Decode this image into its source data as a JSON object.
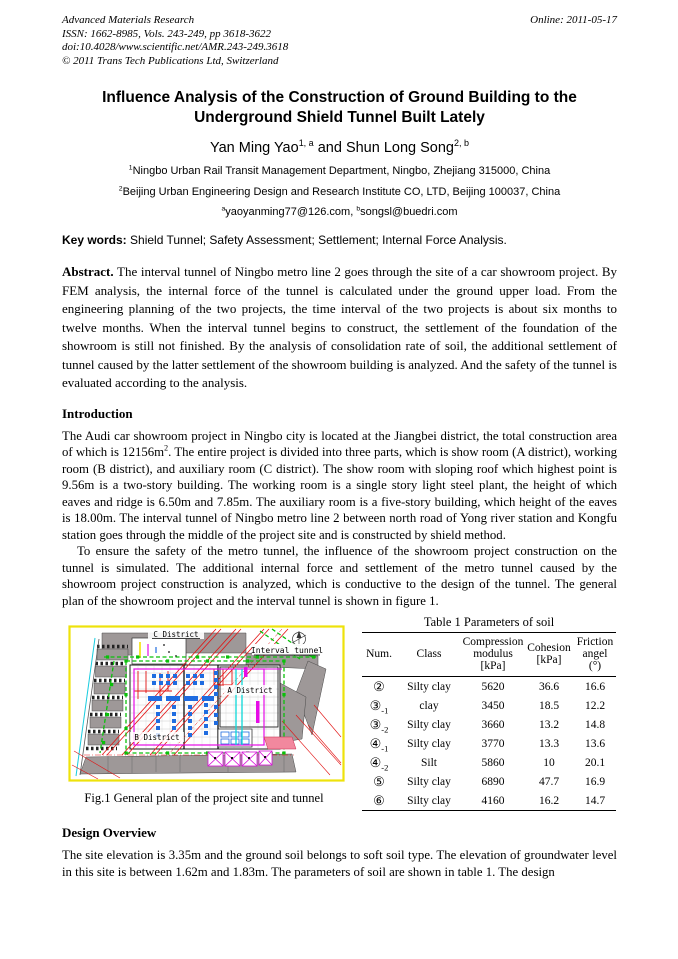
{
  "header": {
    "journal": "Advanced Materials Research",
    "issn": "ISSN: 1662-8985, Vols. 243-249, pp 3618-3622",
    "doi": "doi:10.4028/www.scientific.net/AMR.243-249.3618",
    "copyright": "© 2011 Trans Tech Publications Ltd, Switzerland",
    "online": "Online: 2011-05-17"
  },
  "title": "Influence Analysis of the Construction of Ground Building to the Underground Shield Tunnel Built Lately",
  "authors": {
    "author1": "Yan Ming Yao",
    "author1_sup": "1, a",
    "connector": " and ",
    "author2": "Shun Long Song",
    "author2_sup": "2, b"
  },
  "affiliations": [
    {
      "sup": "1",
      "text": "Ningbo Urban Rail Transit Management Department, Ningbo, Zhejiang 315000, China"
    },
    {
      "sup": "2",
      "text": "Beijing Urban Engineering Design and Research Institute CO, LTD, Beijing 100037, China"
    }
  ],
  "emails": {
    "sup_a": "a",
    "email_a": "yaoyanming77@126.com",
    "separator": ", ",
    "sup_b": "b",
    "email_b": "songsl@buedri.com"
  },
  "keywords": {
    "label": "Key words:",
    "text": " Shield Tunnel; Safety Assessment; Settlement; Internal Force Analysis."
  },
  "abstract": {
    "label": "Abstract.",
    "text": " The interval tunnel of Ningbo metro line 2 goes through the site of a car showroom project. By FEM analysis, the internal force of the tunnel is calculated under the ground upper load. From the engineering planning of the two projects, the time interval of the two projects is about six months to twelve months. When the interval tunnel begins to construct, the settlement of the foundation of the showroom is still not finished. By the analysis of consolidation rate of soil, the additional settlement of tunnel caused by the latter settlement of the showroom building is analyzed. And the safety of the tunnel is evaluated according to the analysis."
  },
  "introduction": {
    "heading": "Introduction",
    "para1_a": "The Audi car showroom project in Ningbo city is located at the Jiangbei district, the total construction area of which is 12156m",
    "para1_sup": "2",
    "para1_b": ". The entire project is divided into three parts, which is show room (A district), working room (B district), and auxiliary room (C district). The show room with sloping roof which highest point is 9.56m is a two-story building. The working room is a single story light steel plant, the height of which eaves and ridge is 6.50m and 7.85m. The auxiliary room is a five-story building, which height of the eaves is 18.00m. The interval tunnel of Ningbo metro line 2 between north road of Yong river station and Kongfu station goes through the middle of the project site and is constructed by shield method.",
    "para2": "To ensure the safety of the metro tunnel, the influence of the showroom project construction on the tunnel is simulated. The additional internal force and settlement of the metro tunnel caused by the showroom project construction is analyzed, which is conductive to the design of the tunnel. The general plan of the showroom project and the interval tunnel is shown in figure 1."
  },
  "figure": {
    "caption": "Fig.1 General plan of the project site and tunnel",
    "labels": {
      "c_district": "C District",
      "interval_tunnel": "Interval tunnel",
      "a_district": "A District",
      "b_district": "B District"
    },
    "colors": {
      "border_yellow": "#eee20b",
      "site_green": "#0ac10a",
      "tunnel_red": "#e31212",
      "column_blue": "#1f6ce0",
      "boundary_magenta": "#e60ce6",
      "pipe_cyan": "#0cd8d8",
      "road_gray": "#9e9898"
    }
  },
  "table": {
    "title": "Table 1 Parameters of soil",
    "headers": {
      "num": "Num.",
      "class": "Class",
      "modulus": "Compression\nmodulus\n[kPa]",
      "cohesion": "Cohesion\n[kPa]",
      "friction": "Friction\nangel\n(°)"
    },
    "rows": [
      {
        "num": "②",
        "sub": "",
        "soil": "Silty clay",
        "modulus": "5620",
        "cohesion": "36.6",
        "friction": "16.6"
      },
      {
        "num": "③",
        "sub": "-1",
        "soil": "clay",
        "modulus": "3450",
        "cohesion": "18.5",
        "friction": "12.2"
      },
      {
        "num": "③",
        "sub": "-2",
        "soil": "Silty clay",
        "modulus": "3660",
        "cohesion": "13.2",
        "friction": "14.8"
      },
      {
        "num": "④",
        "sub": "-1",
        "soil": "Silty clay",
        "modulus": "3770",
        "cohesion": "13.3",
        "friction": "13.6"
      },
      {
        "num": "④",
        "sub": "-2",
        "soil": "Silt",
        "modulus": "5860",
        "cohesion": "10",
        "friction": "20.1"
      },
      {
        "num": "⑤",
        "sub": "",
        "soil": "Silty clay",
        "modulus": "6890",
        "cohesion": "47.7",
        "friction": "16.9"
      },
      {
        "num": "⑥",
        "sub": "",
        "soil": "Silty clay",
        "modulus": "4160",
        "cohesion": "16.2",
        "friction": "14.7"
      }
    ]
  },
  "design": {
    "heading": "Design Overview",
    "para": "The site elevation is 3.35m and the ground soil belongs to soft soil type. The elevation of groundwater level in this site is between 1.62m and 1.83m. The parameters of soil are shown in table 1. The design"
  }
}
